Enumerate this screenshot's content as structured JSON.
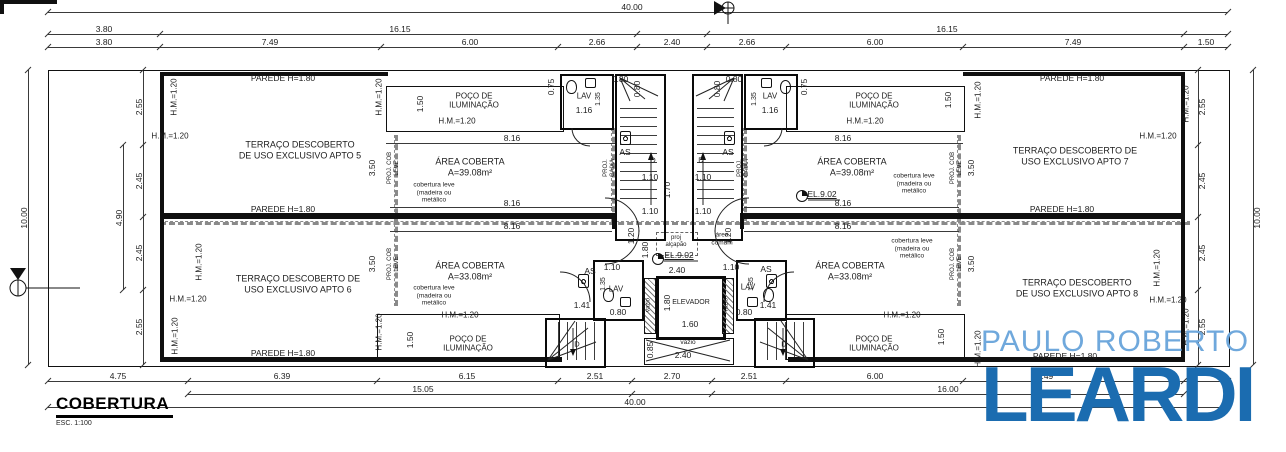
{
  "title_block": {
    "title": "COBERTURA",
    "scale": "ESC. 1:100"
  },
  "logo": {
    "line1": "PAULO ROBERTO",
    "line2": "LEARDI",
    "color_light": "#6fa8dc",
    "color_dark": "#1b6cb0"
  },
  "labels": [
    {
      "n": "dim-label",
      "t": "40.00",
      "x": 632,
      "y": 7
    },
    {
      "n": "dim-label",
      "t": "3.80",
      "x": 104,
      "y": 29
    },
    {
      "n": "dim-label",
      "t": "16.15",
      "x": 400,
      "y": 29
    },
    {
      "n": "dim-label",
      "t": "16.15",
      "x": 947,
      "y": 29
    },
    {
      "n": "dim-label",
      "t": "3.80",
      "x": 104,
      "y": 42
    },
    {
      "n": "dim-label",
      "t": "7.49",
      "x": 270,
      "y": 42
    },
    {
      "n": "dim-label",
      "t": "6.00",
      "x": 470,
      "y": 42
    },
    {
      "n": "dim-label",
      "t": "2.66",
      "x": 597,
      "y": 42
    },
    {
      "n": "dim-label",
      "t": "2.40",
      "x": 672,
      "y": 42
    },
    {
      "n": "dim-label",
      "t": "2.66",
      "x": 747,
      "y": 42
    },
    {
      "n": "dim-label",
      "t": "6.00",
      "x": 875,
      "y": 42
    },
    {
      "n": "dim-label",
      "t": "7.49",
      "x": 1073,
      "y": 42
    },
    {
      "n": "dim-label",
      "t": "1.50",
      "x": 1206,
      "y": 42
    },
    {
      "n": "dim-label",
      "t": "4.75",
      "x": 118,
      "y": 376
    },
    {
      "n": "dim-label",
      "t": "6.39",
      "x": 282,
      "y": 376
    },
    {
      "n": "dim-label",
      "t": "6.15",
      "x": 467,
      "y": 376
    },
    {
      "n": "dim-label",
      "t": "2.51",
      "x": 595,
      "y": 376
    },
    {
      "n": "dim-label",
      "t": "2.70",
      "x": 672,
      "y": 376
    },
    {
      "n": "dim-label",
      "t": "2.51",
      "x": 749,
      "y": 376
    },
    {
      "n": "dim-label",
      "t": "6.00",
      "x": 875,
      "y": 376
    },
    {
      "n": "dim-label",
      "t": "7.49",
      "x": 1045,
      "y": 376
    },
    {
      "n": "dim-label",
      "t": "15.05",
      "x": 423,
      "y": 389
    },
    {
      "n": "dim-label",
      "t": "16.00",
      "x": 948,
      "y": 389
    },
    {
      "n": "dim-label",
      "t": "40.00",
      "x": 635,
      "y": 402
    },
    {
      "n": "dim-label",
      "t": "10.00",
      "x": 24,
      "y": 218,
      "r": 1
    },
    {
      "n": "dim-label",
      "t": "2.55",
      "x": 139,
      "y": 107,
      "r": 1
    },
    {
      "n": "dim-label",
      "t": "2.45",
      "x": 139,
      "y": 181,
      "r": 1
    },
    {
      "n": "dim-label",
      "t": "2.45",
      "x": 139,
      "y": 253,
      "r": 1
    },
    {
      "n": "dim-label",
      "t": "2.55",
      "x": 139,
      "y": 327,
      "r": 1
    },
    {
      "n": "dim-label",
      "t": "4.90",
      "x": 119,
      "y": 218,
      "r": 1
    },
    {
      "n": "dim-label",
      "t": "10.00",
      "x": 1257,
      "y": 218,
      "r": 1
    },
    {
      "n": "dim-label",
      "t": "2.55",
      "x": 1202,
      "y": 107,
      "r": 1
    },
    {
      "n": "dim-label",
      "t": "2.45",
      "x": 1202,
      "y": 181,
      "r": 1
    },
    {
      "n": "dim-label",
      "t": "2.45",
      "x": 1202,
      "y": 253,
      "r": 1
    },
    {
      "n": "dim-label",
      "t": "2.55",
      "x": 1202,
      "y": 327,
      "r": 1
    },
    {
      "n": "wall-height-label",
      "t": "PAREDE H=1.80",
      "x": 283,
      "y": 78
    },
    {
      "n": "wall-height-label",
      "t": "PAREDE H=1.80",
      "x": 283,
      "y": 209
    },
    {
      "n": "wall-height-label",
      "t": "PAREDE H=1.80",
      "x": 283,
      "y": 353
    },
    {
      "n": "wall-height-label",
      "t": "PAREDE H=1.80",
      "x": 1072,
      "y": 78
    },
    {
      "n": "wall-height-label",
      "t": "PAREDE H=1.80",
      "x": 1062,
      "y": 209
    },
    {
      "n": "wall-height-label",
      "t": "PAREDE H=1.80",
      "x": 1065,
      "y": 356
    },
    {
      "n": "wall-height-label",
      "t": "H.M.=1.20",
      "x": 170,
      "y": 136,
      "s": 8
    },
    {
      "n": "wall-height-label",
      "t": "H.M.=1.20",
      "x": 457,
      "y": 121,
      "s": 8
    },
    {
      "n": "wall-height-label",
      "t": "H.M.=1.20",
      "x": 865,
      "y": 121,
      "s": 8
    },
    {
      "n": "wall-height-label",
      "t": "H.M.=1.20",
      "x": 1158,
      "y": 136,
      "s": 8
    },
    {
      "n": "wall-height-label",
      "t": "H.M.=1.20",
      "x": 188,
      "y": 299,
      "s": 8
    },
    {
      "n": "wall-height-label",
      "t": "H.M.=1.20",
      "x": 460,
      "y": 315,
      "s": 8
    },
    {
      "n": "wall-height-label",
      "t": "H.M.=1.20",
      "x": 902,
      "y": 315,
      "s": 8
    },
    {
      "n": "wall-height-label",
      "t": "H.M.=1.20",
      "x": 1168,
      "y": 300,
      "s": 8
    },
    {
      "n": "wall-height-label",
      "t": "H.M.=1.20",
      "x": 174,
      "y": 97,
      "r": 1,
      "s": 8
    },
    {
      "n": "wall-height-label",
      "t": "H.M.=1.20",
      "x": 379,
      "y": 97,
      "r": 1,
      "s": 8
    },
    {
      "n": "wall-height-label",
      "t": "H.M.=1.20",
      "x": 978,
      "y": 100,
      "r": 1,
      "s": 8
    },
    {
      "n": "wall-height-label",
      "t": "H.M.=1.20",
      "x": 1186,
      "y": 104,
      "r": 1,
      "s": 8
    },
    {
      "n": "wall-height-label",
      "t": "H.M.=1.20",
      "x": 199,
      "y": 262,
      "r": 1,
      "s": 8
    },
    {
      "n": "wall-height-label",
      "t": "H.M.=1.20",
      "x": 175,
      "y": 336,
      "r": 1,
      "s": 8
    },
    {
      "n": "wall-height-label",
      "t": "H.M.=1.20",
      "x": 379,
      "y": 332,
      "r": 1,
      "s": 8
    },
    {
      "n": "wall-height-label",
      "t": "H.M.=1.20",
      "x": 978,
      "y": 349,
      "r": 1,
      "s": 8
    },
    {
      "n": "wall-height-label",
      "t": "H.M.=1.20",
      "x": 1157,
      "y": 268,
      "r": 1,
      "s": 8
    },
    {
      "n": "wall-height-label",
      "t": "H.M.=1.20",
      "x": 1186,
      "y": 327,
      "r": 1,
      "s": 8
    },
    {
      "n": "room-label",
      "t": "TERRAÇO DESCOBERTO\nDE USO EXCLUSIVO APTO 5",
      "x": 300,
      "y": 150,
      "s": 9
    },
    {
      "n": "room-label",
      "t": "TERRAÇO DESCOBERTO DE\nUSO EXCLUSIVO APTO 6",
      "x": 298,
      "y": 284,
      "s": 9
    },
    {
      "n": "room-label",
      "t": "TERRAÇO DESCOBERTO DE\nUSO EXCLUSIVO APTO 7",
      "x": 1075,
      "y": 156,
      "s": 9
    },
    {
      "n": "room-label",
      "t": "TERRAÇO DESCOBERTO\nDE USO EXCLUSIVO APTO 8",
      "x": 1077,
      "y": 288,
      "s": 9
    },
    {
      "n": "room-label",
      "t": "POÇO DE\nILUMINAÇÃO",
      "x": 474,
      "y": 101,
      "s": 8
    },
    {
      "n": "room-label",
      "t": "POÇO DE\nILUMINAÇÃO",
      "x": 874,
      "y": 101,
      "s": 8
    },
    {
      "n": "room-label",
      "t": "POÇO DE\nILUMINAÇÃO",
      "x": 468,
      "y": 344,
      "s": 8
    },
    {
      "n": "room-label",
      "t": "POÇO DE\nILUMINAÇÃO",
      "x": 874,
      "y": 344,
      "s": 8
    },
    {
      "n": "room-label",
      "t": "ÁREA COBERTA\nA=39.08m²",
      "x": 470,
      "y": 167,
      "s": 9
    },
    {
      "n": "room-label",
      "t": "ÁREA COBERTA\nA=33.08m²",
      "x": 470,
      "y": 271,
      "s": 9
    },
    {
      "n": "room-label",
      "t": "ÁREA COBERTA\nA=39.08m²",
      "x": 852,
      "y": 167,
      "s": 9
    },
    {
      "n": "room-label",
      "t": "ÁREA COBERTA\nA=33.08m²",
      "x": 850,
      "y": 271,
      "s": 9
    },
    {
      "n": "note-label",
      "t": "cobertura leve\n(madeira ou\nmetálico",
      "x": 434,
      "y": 193,
      "s": 6.5
    },
    {
      "n": "note-label",
      "t": "cobertura leve\n(madeira ou\nmetálico",
      "x": 434,
      "y": 296,
      "s": 6.5
    },
    {
      "n": "note-label",
      "t": "cobertura leve\n(madeira ou\nmetálico",
      "x": 914,
      "y": 184,
      "s": 6.5
    },
    {
      "n": "note-label",
      "t": "cobertura leve\n(madeira ou\nmetálico",
      "x": 912,
      "y": 249,
      "s": 6.5
    },
    {
      "n": "dim-label",
      "t": "3.50",
      "x": 372,
      "y": 168,
      "r": 1
    },
    {
      "n": "dim-label",
      "t": "3.50",
      "x": 372,
      "y": 264,
      "r": 1
    },
    {
      "n": "dim-label",
      "t": "3.50",
      "x": 971,
      "y": 168,
      "r": 1
    },
    {
      "n": "dim-label",
      "t": "3.50",
      "x": 971,
      "y": 264,
      "r": 1
    },
    {
      "n": "note-label",
      "t": "PROJ. COB\nLEVE",
      "x": 394,
      "y": 168,
      "r": 1,
      "s": 6
    },
    {
      "n": "note-label",
      "t": "PROJ. COB\nLEVE",
      "x": 394,
      "y": 264,
      "r": 1,
      "s": 6
    },
    {
      "n": "note-label",
      "t": "PROJ. COB\nLEVE",
      "x": 957,
      "y": 168,
      "r": 1,
      "s": 6
    },
    {
      "n": "note-label",
      "t": "PROJ. COB\nLEVE",
      "x": 957,
      "y": 264,
      "r": 1,
      "s": 6
    },
    {
      "n": "note-label",
      "t": "PROJ.\nCAIXA",
      "x": 610,
      "y": 168,
      "r": 1,
      "s": 6
    },
    {
      "n": "note-label",
      "t": "PROJ.\nCAIXA",
      "x": 744,
      "y": 168,
      "r": 1,
      "s": 6
    },
    {
      "n": "dim-label",
      "t": "8.16",
      "x": 512,
      "y": 138
    },
    {
      "n": "dim-label",
      "t": "8.16",
      "x": 512,
      "y": 203
    },
    {
      "n": "dim-label",
      "t": "8.16",
      "x": 512,
      "y": 226
    },
    {
      "n": "dim-label",
      "t": "8.16",
      "x": 843,
      "y": 138
    },
    {
      "n": "dim-label",
      "t": "8.16",
      "x": 843,
      "y": 203
    },
    {
      "n": "dim-label",
      "t": "8.16",
      "x": 843,
      "y": 226
    },
    {
      "n": "room-label",
      "t": "LAV",
      "x": 584,
      "y": 96,
      "s": 8
    },
    {
      "n": "room-label",
      "t": "LAV",
      "x": 770,
      "y": 96,
      "s": 8
    },
    {
      "n": "room-label",
      "t": "LAV",
      "x": 616,
      "y": 289,
      "s": 8
    },
    {
      "n": "room-label",
      "t": "LAV",
      "x": 748,
      "y": 287,
      "s": 8
    },
    {
      "n": "dim-label",
      "t": "1.16",
      "x": 584,
      "y": 110
    },
    {
      "n": "dim-label",
      "t": "1.16",
      "x": 770,
      "y": 110
    },
    {
      "n": "dim-label",
      "t": "1.35",
      "x": 599,
      "y": 99,
      "r": 1,
      "s": 7
    },
    {
      "n": "dim-label",
      "t": "1.35",
      "x": 755,
      "y": 99,
      "r": 1,
      "s": 7
    },
    {
      "n": "dim-label",
      "t": "1.35",
      "x": 604,
      "y": 284,
      "r": 1,
      "s": 7
    },
    {
      "n": "dim-label",
      "t": "1.35",
      "x": 752,
      "y": 284,
      "r": 1,
      "s": 7
    },
    {
      "n": "dim-label",
      "t": "0.75",
      "x": 551,
      "y": 87,
      "r": 1
    },
    {
      "n": "dim-label",
      "t": "0.75",
      "x": 804,
      "y": 87,
      "r": 1
    },
    {
      "n": "dim-label",
      "t": "0.80",
      "x": 620,
      "y": 79
    },
    {
      "n": "dim-label",
      "t": "0.80",
      "x": 734,
      "y": 79
    },
    {
      "n": "dim-label",
      "t": "0.80",
      "x": 637,
      "y": 89,
      "r": 1
    },
    {
      "n": "dim-label",
      "t": "0.80",
      "x": 717,
      "y": 89,
      "r": 1
    },
    {
      "n": "dim-label",
      "t": "0.80",
      "x": 618,
      "y": 312
    },
    {
      "n": "dim-label",
      "t": "0.80",
      "x": 744,
      "y": 312
    },
    {
      "n": "room-label",
      "t": "AS",
      "x": 625,
      "y": 152,
      "s": 8.5
    },
    {
      "n": "room-label",
      "t": "AS",
      "x": 728,
      "y": 152,
      "s": 8.5
    },
    {
      "n": "room-label",
      "t": "AS",
      "x": 590,
      "y": 271,
      "s": 8.5
    },
    {
      "n": "room-label",
      "t": "AS",
      "x": 766,
      "y": 269,
      "s": 8.5
    },
    {
      "n": "stair-direction-label",
      "t": "D",
      "x": 653,
      "y": 161,
      "s": 7.5
    },
    {
      "n": "stair-direction-label",
      "t": "D",
      "x": 701,
      "y": 161,
      "s": 7.5
    },
    {
      "n": "stair-direction-label",
      "t": "D",
      "x": 577,
      "y": 345,
      "s": 7.5
    },
    {
      "n": "stair-direction-label",
      "t": "D",
      "x": 784,
      "y": 345,
      "s": 7.5
    },
    {
      "n": "dim-label",
      "t": "1.10",
      "x": 650,
      "y": 177
    },
    {
      "n": "dim-label",
      "t": "1.10",
      "x": 703,
      "y": 177
    },
    {
      "n": "dim-label",
      "t": "1.10",
      "x": 650,
      "y": 211
    },
    {
      "n": "dim-label",
      "t": "1.10",
      "x": 703,
      "y": 211
    },
    {
      "n": "dim-label",
      "t": "1.10",
      "x": 612,
      "y": 267
    },
    {
      "n": "dim-label",
      "t": "1.10",
      "x": 731,
      "y": 267
    },
    {
      "n": "dim-label",
      "t": "1.70",
      "x": 667,
      "y": 190,
      "r": 1
    },
    {
      "n": "dim-label",
      "t": "1.20",
      "x": 631,
      "y": 236,
      "r": 1
    },
    {
      "n": "dim-label",
      "t": "1.20",
      "x": 728,
      "y": 236,
      "r": 1
    },
    {
      "n": "dim-label",
      "t": "1.80",
      "x": 645,
      "y": 250,
      "r": 1
    },
    {
      "n": "note-label",
      "t": "proj\nalçapão",
      "x": 676,
      "y": 242,
      "s": 6
    },
    {
      "n": "note-label",
      "t": "área\ncomum",
      "x": 722,
      "y": 239,
      "s": 6.5
    },
    {
      "n": "level-label",
      "t": "EL.9.02",
      "x": 822,
      "y": 194,
      "u": 1
    },
    {
      "n": "level-label",
      "t": "EL.9.02",
      "x": 679,
      "y": 255,
      "u": 1
    },
    {
      "n": "dim-label",
      "t": "2.40",
      "x": 677,
      "y": 270
    },
    {
      "n": "room-label",
      "t": "ELEVADOR",
      "x": 691,
      "y": 303,
      "s": 7
    },
    {
      "n": "dim-label",
      "t": "1.80",
      "x": 667,
      "y": 303,
      "r": 1
    },
    {
      "n": "dim-label",
      "t": "1.60",
      "x": 690,
      "y": 324
    },
    {
      "n": "void-label",
      "t": "vazio",
      "x": 649,
      "y": 305,
      "r": 1,
      "s": 6
    },
    {
      "n": "void-label",
      "t": "vazio",
      "x": 727,
      "y": 305,
      "r": 1,
      "s": 6
    },
    {
      "n": "void-label",
      "t": "vazio",
      "x": 688,
      "y": 343,
      "s": 6.5
    },
    {
      "n": "dim-label",
      "t": "2.40",
      "x": 683,
      "y": 355
    },
    {
      "n": "dim-label",
      "t": "0.85",
      "x": 650,
      "y": 350,
      "r": 1
    },
    {
      "n": "dim-label",
      "t": "1.41",
      "x": 582,
      "y": 305
    },
    {
      "n": "dim-label",
      "t": "1.41",
      "x": 768,
      "y": 305
    },
    {
      "n": "dim-label",
      "t": "1.50",
      "x": 420,
      "y": 104,
      "r": 1
    },
    {
      "n": "dim-label",
      "t": "1.50",
      "x": 948,
      "y": 100,
      "r": 1
    },
    {
      "n": "dim-label",
      "t": "1.50",
      "x": 410,
      "y": 340,
      "r": 1
    },
    {
      "n": "dim-label",
      "t": "1.50",
      "x": 941,
      "y": 337,
      "r": 1
    }
  ]
}
